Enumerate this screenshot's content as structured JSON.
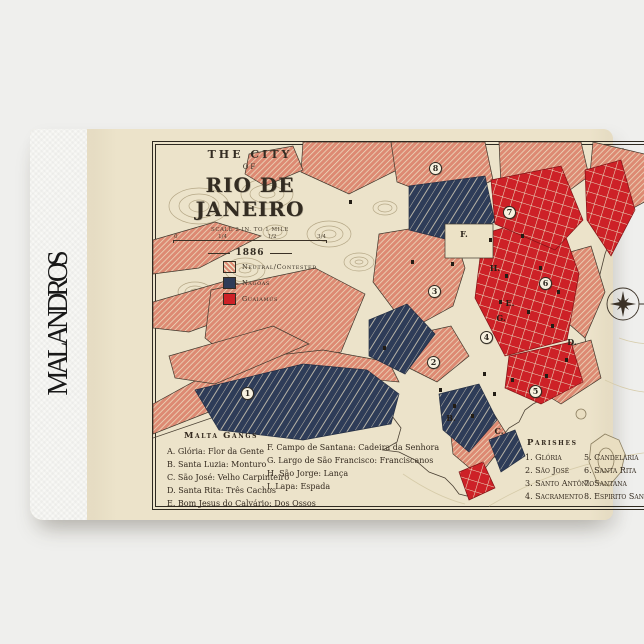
{
  "product": {
    "brand": "MALANDROS"
  },
  "map": {
    "title_line1": "THE CITY",
    "title_line2": "OF",
    "title_line3": "RIO DE JANEIRO",
    "scale_label": "SCALE 2 IN. TO 1 MILE",
    "scale_ticks": [
      "0",
      "1/4",
      "1/2",
      "3/4"
    ],
    "year": "1886",
    "colors": {
      "paper": "#ece3ca",
      "neutral_salmon": "#dd8a73",
      "nagoas_navy": "#2e3c58",
      "guaiamus_red": "#cd2127",
      "ink": "#332c22"
    },
    "legend": {
      "items": [
        {
          "label": "Neutral/Contested",
          "color": "#dd8a73",
          "style": "hatched"
        },
        {
          "label": "Nagoas",
          "color": "#2e3c58",
          "style": "solid"
        },
        {
          "label": "Guaiamús",
          "color": "#cd2127",
          "style": "solid"
        }
      ]
    },
    "markers": [
      {
        "label": "1",
        "x": 95,
        "y": 252
      },
      {
        "label": "2",
        "x": 281,
        "y": 221
      },
      {
        "label": "3",
        "x": 282,
        "y": 150
      },
      {
        "label": "4",
        "x": 334,
        "y": 196
      },
      {
        "label": "5",
        "x": 383,
        "y": 250
      },
      {
        "label": "6",
        "x": 393,
        "y": 142
      },
      {
        "label": "7",
        "x": 357,
        "y": 71
      },
      {
        "label": "8",
        "x": 283,
        "y": 27
      }
    ],
    "letter_markers": [
      {
        "label": "B.",
        "x": 298,
        "y": 276
      },
      {
        "label": "C.",
        "x": 346,
        "y": 289
      },
      {
        "label": "D.",
        "x": 419,
        "y": 200
      },
      {
        "label": "E.",
        "x": 357,
        "y": 161
      },
      {
        "label": "F.",
        "x": 311,
        "y": 92
      },
      {
        "label": "G.",
        "x": 348,
        "y": 176
      },
      {
        "label": "H.",
        "x": 342,
        "y": 126
      }
    ],
    "malta_gangs": {
      "title": "Malta Gangs",
      "column1": [
        "A. Glória: Flor da Gente",
        "B. Santa Luzia: Monturo",
        "C. São José: Velho Carpinteiro",
        "D. Santa Rita: Três Cachos",
        "E. Bom Jesus do Calvário: Dos Ossos"
      ],
      "column2": [
        "F. Campo de Santana: Cadeira da Senhora",
        "G. Largo de São Francisco: Franciscanos",
        "H. São Jorge: Lança",
        "I. Lapa: Espada"
      ]
    },
    "parishes": {
      "title": "Parishes",
      "column1": [
        "1. Glória",
        "2. São José",
        "3. Santo Antônio",
        "4. Sacramento"
      ],
      "column2": [
        "5. Candelária",
        "6. Santa Rita",
        "7. Santana",
        "8. Espirito Santo"
      ]
    }
  }
}
